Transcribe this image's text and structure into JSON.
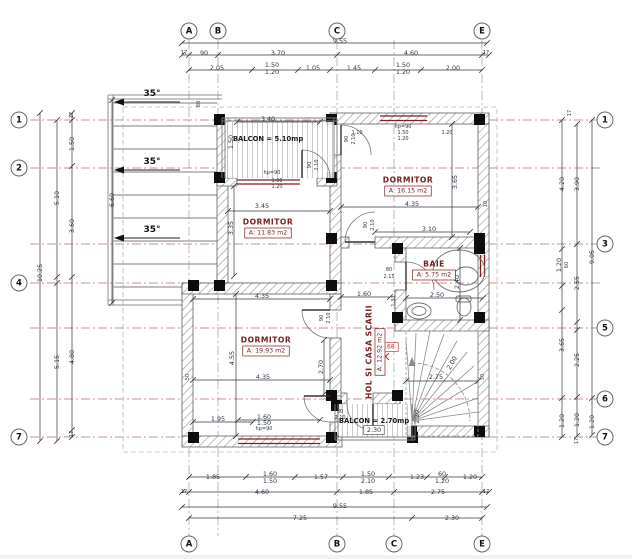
{
  "drawing": {
    "type": "floor-plan",
    "colors": {
      "axis_red": "#b5524a",
      "axis_gray": "#9aa0a6",
      "dimension": "#2f3640",
      "wall_hatch": "#9a9a9a",
      "column": "#0d0d0d",
      "window": "#7a2020",
      "room_label": "#7a1c1c",
      "red_mark": "#cc2222"
    },
    "axes": {
      "top": [
        {
          "label": "A",
          "x": 189
        },
        {
          "label": "B",
          "x": 218
        },
        {
          "label": "C",
          "x": 337
        },
        {
          "label": "E",
          "x": 482
        }
      ],
      "bottom": [
        {
          "label": "A",
          "x": 189
        },
        {
          "label": "B",
          "x": 337
        },
        {
          "label": "C",
          "x": 394
        },
        {
          "label": "E",
          "x": 482
        }
      ],
      "left": [
        {
          "label": "1",
          "y": 120
        },
        {
          "label": "2",
          "y": 168
        },
        {
          "label": "4",
          "y": 283
        },
        {
          "label": "7",
          "y": 437
        }
      ],
      "right": [
        {
          "label": "1",
          "y": 120
        },
        {
          "label": "3",
          "y": 244
        },
        {
          "label": "5",
          "y": 328
        },
        {
          "label": "6",
          "y": 399
        },
        {
          "label": "7",
          "y": 437
        }
      ]
    },
    "rooms": [
      {
        "name": "DORMITOR",
        "area": "A: 11.83 m2",
        "x": 268,
        "y": 222,
        "r": 0
      },
      {
        "name": "DORMITOR",
        "area": "A: 16.15 m2",
        "x": 408,
        "y": 180,
        "r": 0
      },
      {
        "name": "BAIE",
        "area": "A: 5.75 m2",
        "x": 434,
        "y": 264,
        "r": 0
      },
      {
        "name": "DORMITOR",
        "area": "A: 19.93 m2",
        "x": 266,
        "y": 340,
        "r": 0
      },
      {
        "name": "HOL SI CASA SCARII",
        "area": "A: 12.92 m2",
        "x": 369,
        "y": 352,
        "r": -90
      }
    ],
    "balconies": [
      {
        "label": "BALCON = 5.10mp",
        "x": 268,
        "y": 139
      },
      {
        "label": "BALCON = 2.70mp",
        "x": 374,
        "y": 421
      }
    ],
    "slope_label": "35°",
    "slope_positions": [
      [
        152,
        96
      ],
      [
        152,
        164
      ],
      [
        152,
        232
      ]
    ],
    "annotations": [
      {
        "t": "9.55",
        "x": 340,
        "y": 41
      },
      {
        "t": "17",
        "x": 184,
        "y": 53,
        "s": "tiny"
      },
      {
        "t": "90",
        "x": 204,
        "y": 53
      },
      {
        "t": "3.70",
        "x": 278,
        "y": 53
      },
      {
        "t": "4.60",
        "x": 411,
        "y": 53
      },
      {
        "t": "17",
        "x": 486,
        "y": 53,
        "s": "tiny"
      },
      {
        "t": "2.05",
        "x": 217,
        "y": 68
      },
      {
        "t": "1.50",
        "x": 272,
        "y": 65
      },
      {
        "t": "1.20",
        "x": 272,
        "y": 72
      },
      {
        "t": "1.05",
        "x": 313,
        "y": 68
      },
      {
        "t": "1.45",
        "x": 354,
        "y": 68
      },
      {
        "t": "1.50",
        "x": 403,
        "y": 65
      },
      {
        "t": "1.20",
        "x": 403,
        "y": 72
      },
      {
        "t": "2.00",
        "x": 453,
        "y": 68
      },
      {
        "t": "1.85",
        "x": 213,
        "y": 477
      },
      {
        "t": "1.60",
        "x": 270,
        "y": 474
      },
      {
        "t": "1.50",
        "x": 270,
        "y": 481
      },
      {
        "t": "1.57",
        "x": 321,
        "y": 477
      },
      {
        "t": "1.50",
        "x": 368,
        "y": 474
      },
      {
        "t": "2.10",
        "x": 368,
        "y": 481
      },
      {
        "t": "1.23",
        "x": 417,
        "y": 477
      },
      {
        "t": "60",
        "x": 442,
        "y": 474
      },
      {
        "t": "1.20",
        "x": 442,
        "y": 481
      },
      {
        "t": "1.20",
        "x": 470,
        "y": 477
      },
      {
        "t": "17",
        "x": 184,
        "y": 492,
        "s": "tiny"
      },
      {
        "t": "4.60",
        "x": 262,
        "y": 492
      },
      {
        "t": "1.85",
        "x": 366,
        "y": 492
      },
      {
        "t": "2.75",
        "x": 438,
        "y": 492
      },
      {
        "t": "17",
        "x": 486,
        "y": 492,
        "s": "tiny"
      },
      {
        "t": "9.55",
        "x": 340,
        "y": 506
      },
      {
        "t": "7.25",
        "x": 300,
        "y": 518
      },
      {
        "t": "2.30",
        "x": 452,
        "y": 518
      },
      {
        "t": "10.25",
        "x": 40,
        "y": 273,
        "r": -90
      },
      {
        "t": "5.10",
        "x": 57,
        "y": 198,
        "r": -90
      },
      {
        "t": "5.15",
        "x": 57,
        "y": 362,
        "r": -90
      },
      {
        "t": "17",
        "x": 72,
        "y": 115,
        "r": -90,
        "s": "tiny"
      },
      {
        "t": "1.50",
        "x": 72,
        "y": 144,
        "r": -90
      },
      {
        "t": "3.60",
        "x": 72,
        "y": 226,
        "r": -90
      },
      {
        "t": "4.80",
        "x": 72,
        "y": 357,
        "r": -90
      },
      {
        "t": "17",
        "x": 72,
        "y": 434,
        "r": -90,
        "s": "tiny"
      },
      {
        "t": "6.60",
        "x": 112,
        "y": 200,
        "r": -90
      },
      {
        "t": "80",
        "x": 199,
        "y": 104,
        "r": -90,
        "s": "tiny"
      },
      {
        "t": "17",
        "x": 570,
        "y": 113,
        "r": -90,
        "s": "tiny"
      },
      {
        "t": "4.20",
        "x": 562,
        "y": 184,
        "r": -90
      },
      {
        "t": "3.90",
        "x": 577,
        "y": 184,
        "r": -90
      },
      {
        "t": "9.05",
        "x": 592,
        "y": 257,
        "r": -90
      },
      {
        "t": "1.20",
        "x": 559,
        "y": 265,
        "r": -90
      },
      {
        "t": "60",
        "x": 567,
        "y": 265,
        "r": -90,
        "s": "tiny"
      },
      {
        "t": "2.55",
        "x": 577,
        "y": 283,
        "r": -90
      },
      {
        "t": "3.65",
        "x": 562,
        "y": 345,
        "r": -90
      },
      {
        "t": "2.25",
        "x": 577,
        "y": 360,
        "r": -90
      },
      {
        "t": "1.20",
        "x": 562,
        "y": 421,
        "r": -90
      },
      {
        "t": "1.20",
        "x": 577,
        "y": 420,
        "r": -90
      },
      {
        "t": "1.20",
        "x": 592,
        "y": 422,
        "r": -90
      },
      {
        "t": "17",
        "x": 577,
        "y": 441,
        "r": -90,
        "s": "tiny"
      },
      {
        "t": "3.40",
        "x": 268,
        "y": 119
      },
      {
        "t": "1.50",
        "x": 231,
        "y": 142,
        "r": -90
      },
      {
        "t": "3.45",
        "x": 262,
        "y": 206
      },
      {
        "t": "3.35",
        "x": 231,
        "y": 228,
        "r": -90
      },
      {
        "t": "hp=90",
        "x": 272,
        "y": 173,
        "s": "tiny"
      },
      {
        "t": "1.00",
        "x": 277,
        "y": 181,
        "s": "tiny"
      },
      {
        "t": "1.20",
        "x": 277,
        "y": 187,
        "s": "tiny"
      },
      {
        "t": "90",
        "x": 310,
        "y": 165,
        "r": -90,
        "s": "tiny"
      },
      {
        "t": "2.10",
        "x": 317,
        "y": 165,
        "r": -90,
        "s": "tiny"
      },
      {
        "t": "90",
        "x": 347,
        "y": 139,
        "r": -90,
        "s": "tiny"
      },
      {
        "t": "2.10",
        "x": 354,
        "y": 139,
        "r": -90,
        "s": "tiny"
      },
      {
        "t": "1.10",
        "x": 357,
        "y": 133,
        "s": "tiny"
      },
      {
        "t": "hp=90",
        "x": 403,
        "y": 127,
        "s": "tiny"
      },
      {
        "t": "1.50",
        "x": 403,
        "y": 133,
        "s": "tiny"
      },
      {
        "t": "1.20",
        "x": 403,
        "y": 139,
        "s": "tiny"
      },
      {
        "t": "1.20",
        "x": 447,
        "y": 133,
        "s": "tiny"
      },
      {
        "t": "4.35",
        "x": 412,
        "y": 204
      },
      {
        "t": "3.65",
        "x": 455,
        "y": 182,
        "r": -90
      },
      {
        "t": "3.10",
        "x": 429,
        "y": 229
      },
      {
        "t": "10",
        "x": 486,
        "y": 204,
        "r": -90,
        "s": "tiny"
      },
      {
        "t": "90",
        "x": 366,
        "y": 225,
        "r": -90,
        "s": "tiny"
      },
      {
        "t": "2.10",
        "x": 373,
        "y": 225,
        "r": -90,
        "s": "tiny"
      },
      {
        "t": "2.50",
        "x": 437,
        "y": 295
      },
      {
        "t": "2.40",
        "x": 457,
        "y": 282,
        "r": -90
      },
      {
        "t": "80",
        "x": 389,
        "y": 270,
        "s": "tiny"
      },
      {
        "t": "2.15",
        "x": 389,
        "y": 277,
        "s": "tiny"
      },
      {
        "t": "1.60",
        "x": 364,
        "y": 294
      },
      {
        "t": "2.68",
        "x": 388,
        "y": 347,
        "s": "red",
        "box": "#cc2222"
      },
      {
        "t": "2.75",
        "x": 436,
        "y": 377
      },
      {
        "t": "2.00",
        "x": 452,
        "y": 363,
        "r": -60
      },
      {
        "t": "1.33",
        "x": 394,
        "y": 301,
        "r": -90,
        "s": "tiny"
      },
      {
        "t": "30",
        "x": 483,
        "y": 377,
        "r": -90,
        "s": "tiny"
      },
      {
        "t": "4.35",
        "x": 262,
        "y": 296
      },
      {
        "t": "4.55",
        "x": 232,
        "y": 358,
        "r": -90
      },
      {
        "t": "4.35",
        "x": 263,
        "y": 377
      },
      {
        "t": "50",
        "x": 188,
        "y": 377,
        "r": -90,
        "s": "tiny"
      },
      {
        "t": "2.70",
        "x": 321,
        "y": 367,
        "r": -90
      },
      {
        "t": "90",
        "x": 322,
        "y": 318,
        "r": -90,
        "s": "tiny"
      },
      {
        "t": "2.10",
        "x": 329,
        "y": 318,
        "r": -90,
        "s": "tiny"
      },
      {
        "t": "1.95",
        "x": 218,
        "y": 419
      },
      {
        "t": "1.60",
        "x": 264,
        "y": 417
      },
      {
        "t": "1.50",
        "x": 264,
        "y": 423
      },
      {
        "t": "hp=90",
        "x": 264,
        "y": 429,
        "s": "tiny"
      },
      {
        "t": "80",
        "x": 340,
        "y": 412,
        "s": "tiny"
      },
      {
        "t": "2.10",
        "x": 340,
        "y": 418,
        "s": "tiny"
      },
      {
        "t": "2.30",
        "x": 374,
        "y": 430,
        "box": "#2f3640"
      },
      {
        "t": "1.20",
        "x": 417,
        "y": 417,
        "r": -90
      }
    ]
  }
}
